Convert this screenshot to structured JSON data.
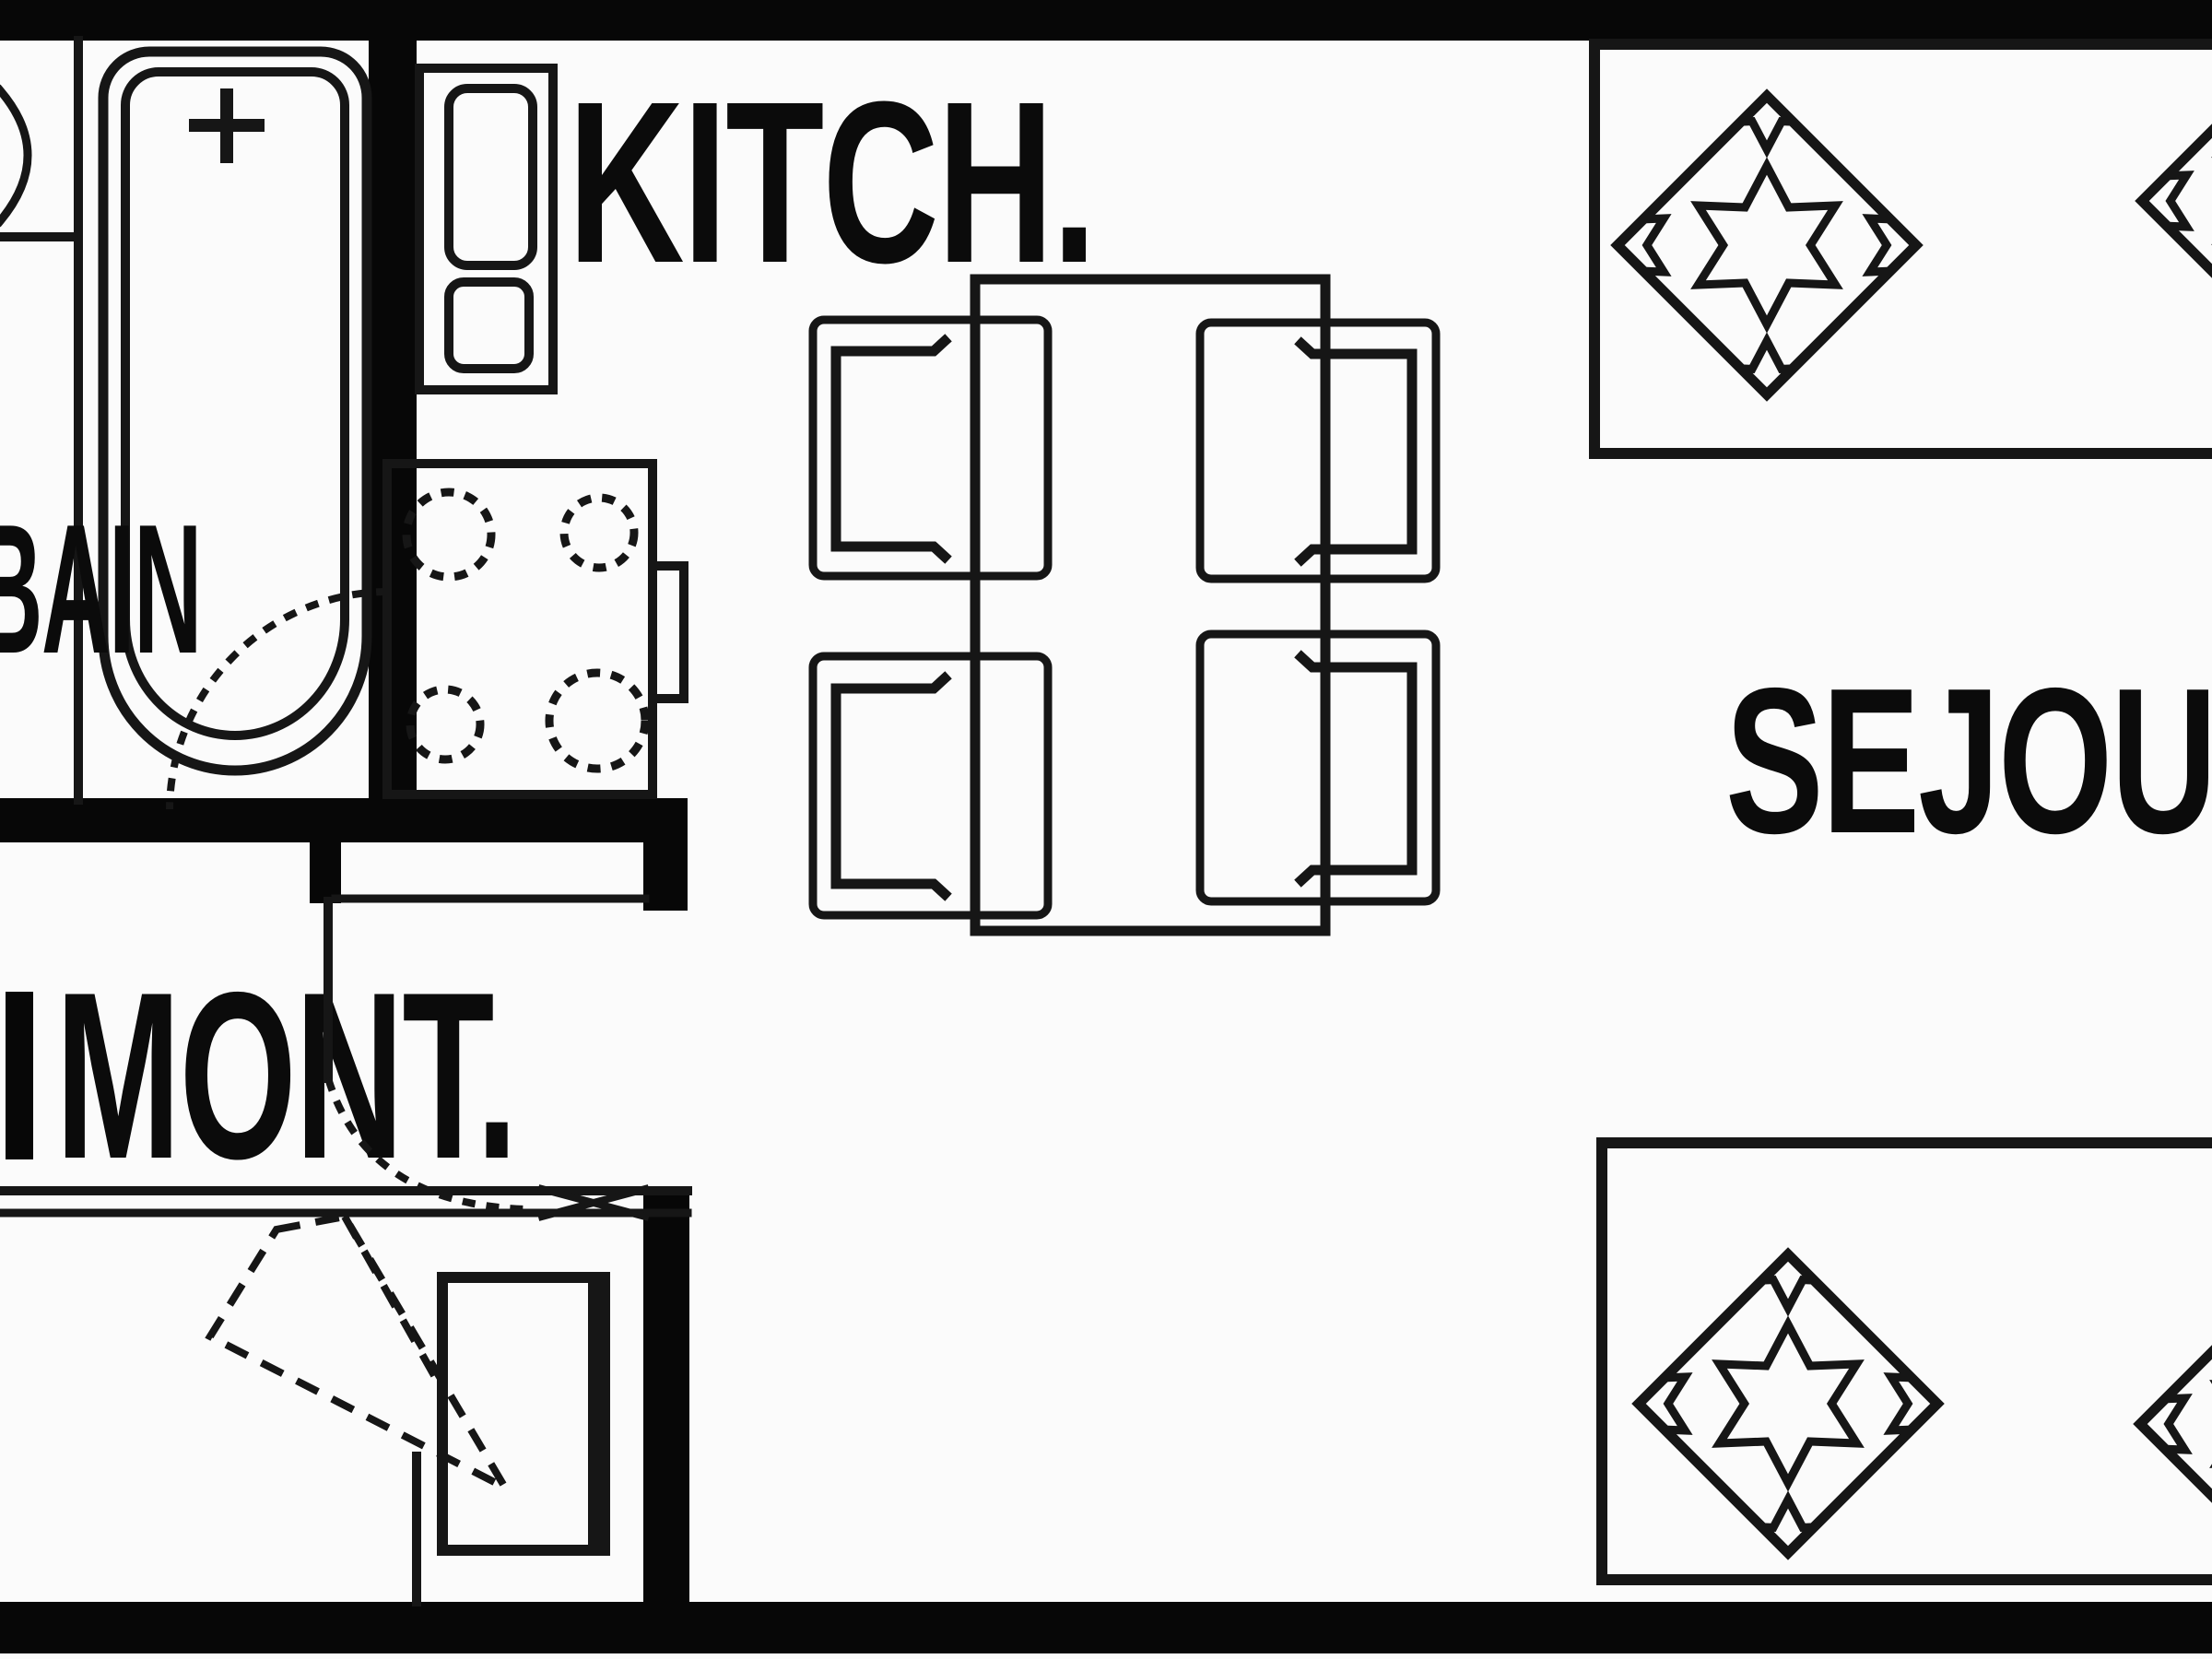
{
  "plan": {
    "type": "apartment-floor-plan",
    "colors": {
      "ink": "#161616",
      "wall": "#070707",
      "background": "#fbfbfb"
    },
    "rooms": {
      "bathroom": {
        "label": "BAIN"
      },
      "kitchen": {
        "label": "KITCH."
      },
      "stairs": {
        "label": "MONT."
      },
      "living_room": {
        "label": "SEJOUR"
      }
    }
  }
}
